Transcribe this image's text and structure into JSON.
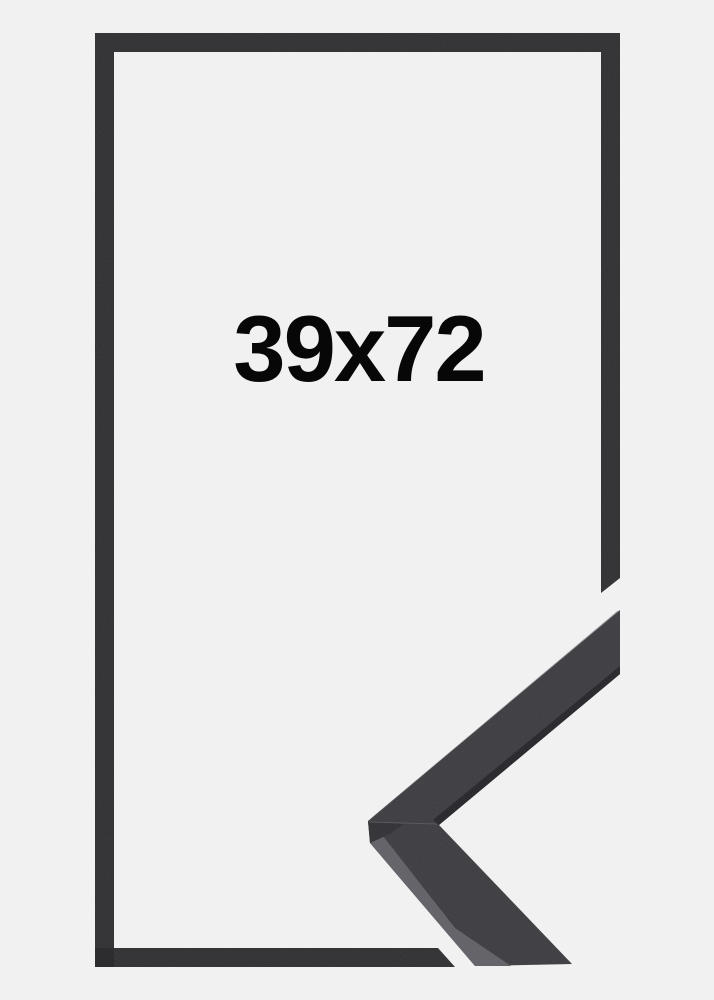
{
  "product_image": {
    "size_label": "39x72",
    "colors": {
      "background": "#f1f1f2",
      "frame_outline": "#2d2d2f",
      "corner_face": "#3a3a3e",
      "corner_side_light": "#5e5e64",
      "corner_inner_lip": "#232327",
      "corner_bevel": "#2e2e32",
      "corner_seam": "#55555a",
      "edge_highlight": "#55555a",
      "label_text": "#070707"
    }
  }
}
